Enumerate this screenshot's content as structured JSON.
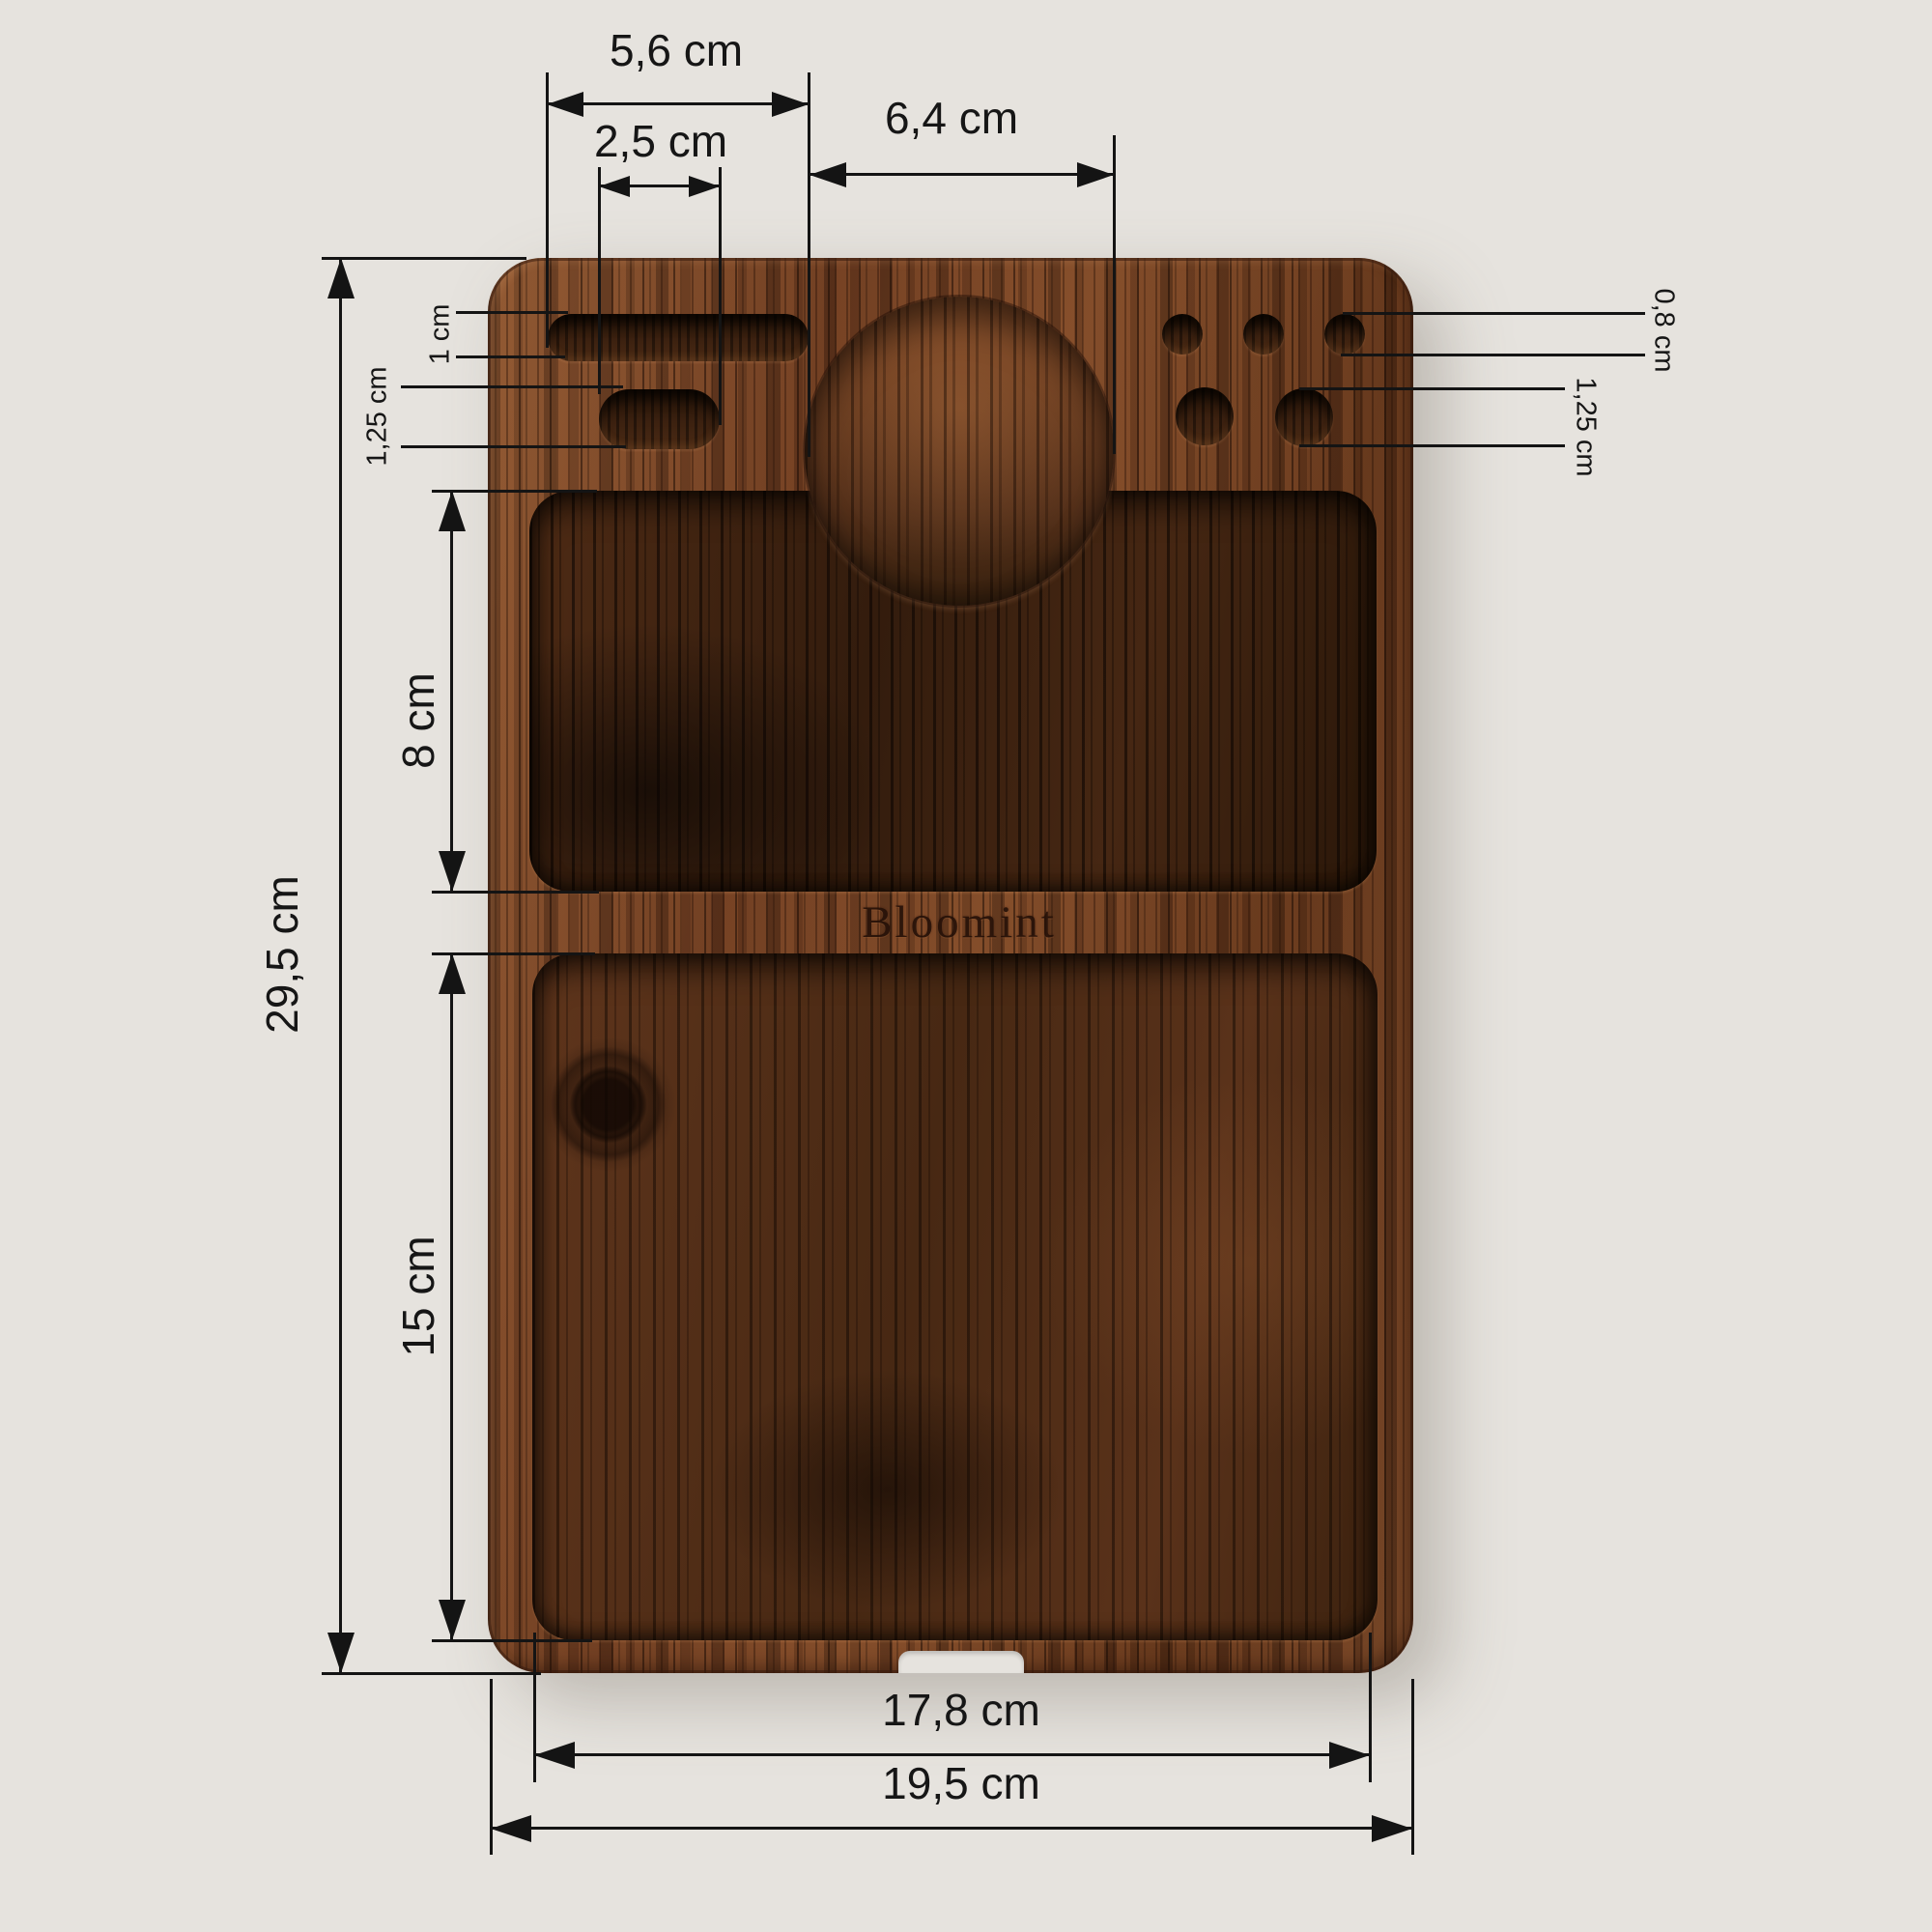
{
  "board": {
    "logo_text": "Bloomint",
    "wood_color": "#7b4527",
    "background_color": "#e6e3de"
  },
  "dimensions": {
    "long_slot_width": "5,6 cm",
    "short_slot_width": "2,5 cm",
    "round_recess_diameter": "6,4 cm",
    "long_slot_height": "1 cm",
    "short_slot_height": "1,25 cm",
    "board_height": "29,5 cm",
    "upper_recess_height": "8 cm",
    "lower_recess_height": "15 cm",
    "small_hole_diameter": "0,8 cm",
    "large_hole_diameter": "1,25 cm",
    "inner_recess_width": "17,8 cm",
    "board_width": "19,5 cm"
  }
}
